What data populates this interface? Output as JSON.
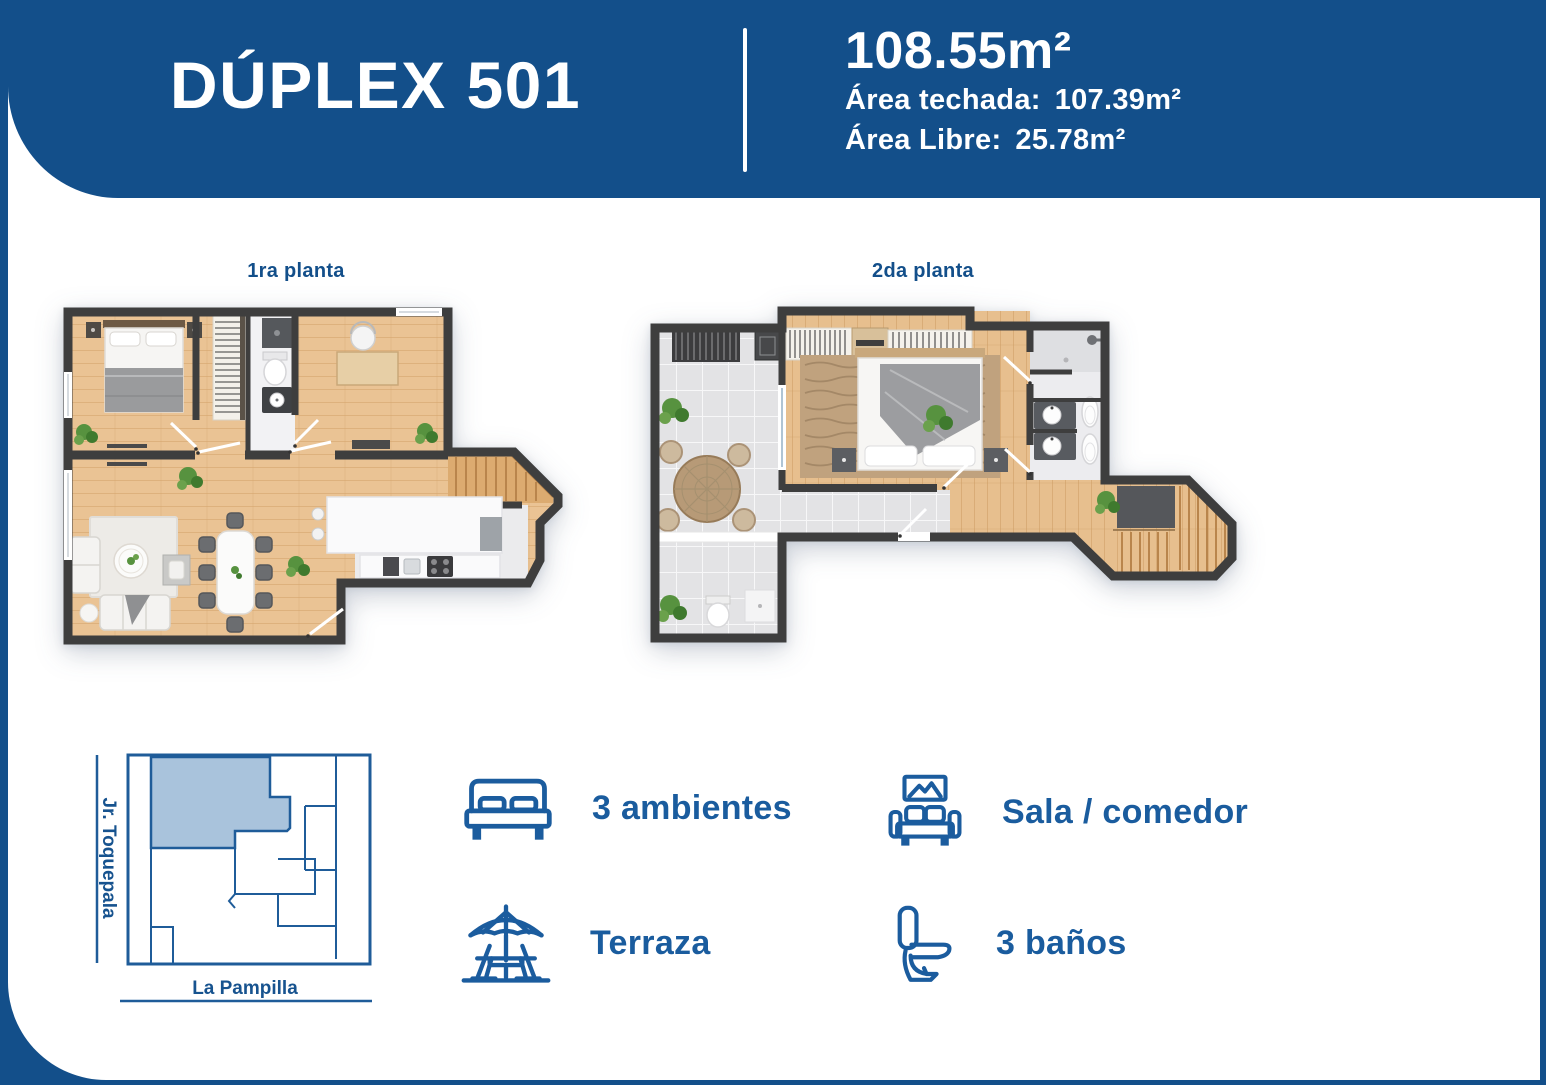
{
  "colors": {
    "primary_blue": "#134F8A",
    "accent_text_blue": "#1A5C9E",
    "map_highlight": "#A9C3DC",
    "wall_gray": "#3E3E3E",
    "wood_floor": "#EAC394",
    "tile_gray": "#E3E3E5"
  },
  "header": {
    "title": "DÚPLEX 501",
    "total_area": "108.55m²",
    "roofed_area_label": "Área techada:",
    "roofed_area_value": "107.39m²",
    "free_area_label": "Área Libre:",
    "free_area_value": "25.78m²"
  },
  "plans": {
    "first_label": "1ra planta",
    "second_label": "2da planta"
  },
  "site_map": {
    "street_left": "Jr. Toquepala",
    "street_bottom": "La Pampilla"
  },
  "features": [
    {
      "icon": "bed-icon",
      "label": "3 ambientes"
    },
    {
      "icon": "sofa-icon",
      "label": "Sala / comedor"
    },
    {
      "icon": "terrace-icon",
      "label": "Terraza"
    },
    {
      "icon": "toilet-icon",
      "label": "3 baños"
    }
  ]
}
